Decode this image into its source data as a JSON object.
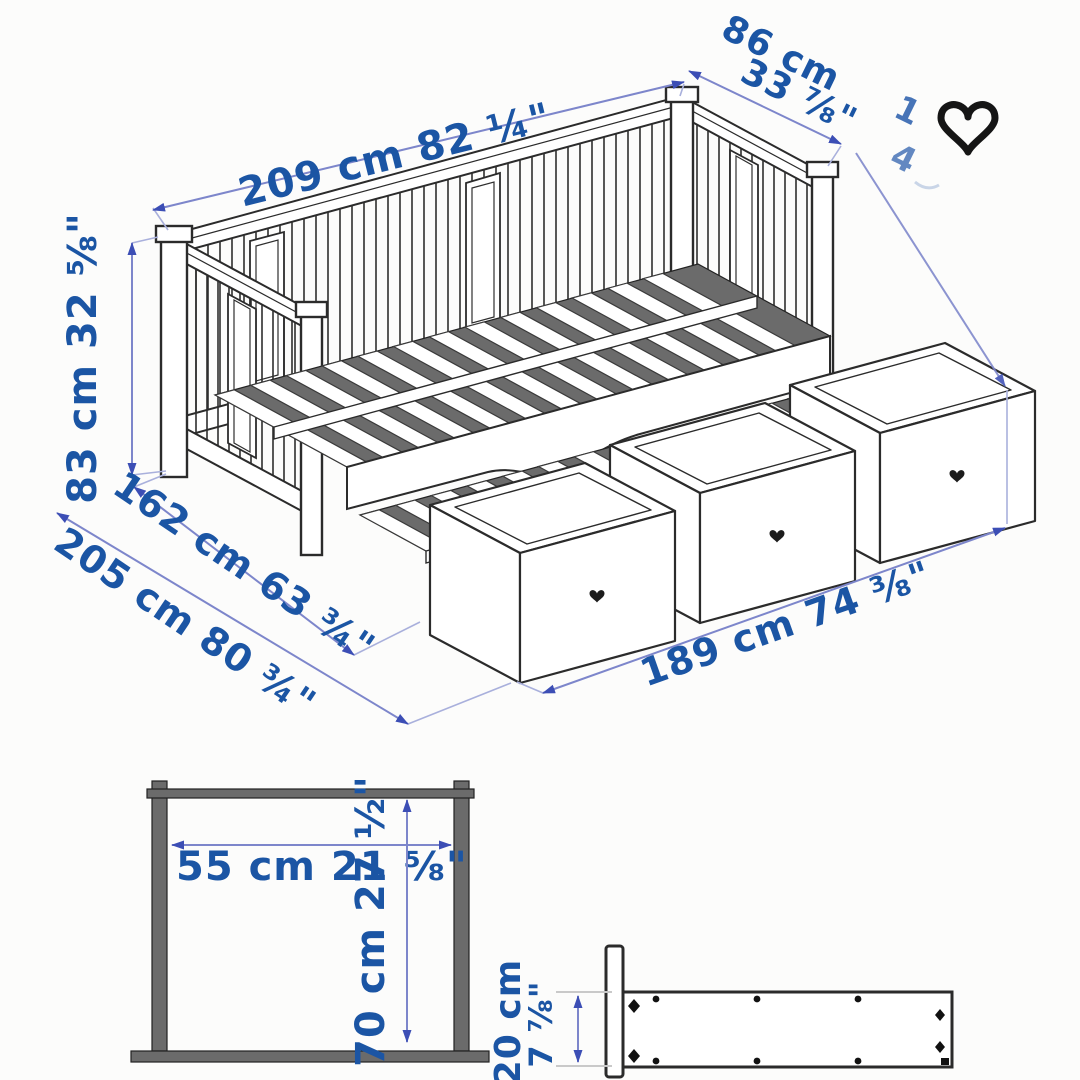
{
  "page": {
    "background": "#fcfcfb",
    "description": "Isometric dimension drawing of a daybed with three storage drawers, plus headboard clearance and side-rail detail views"
  },
  "colors": {
    "dim_text": "#1b55a4",
    "dim_line": "#7d86cb",
    "dim_arrow": "#3c4eb5",
    "draw_stroke": "#2b2b2b",
    "gray_fill": "#6b6b6b",
    "heart_icon": "#151515"
  },
  "main_diagram": {
    "dims": {
      "length_top": "209 cm 82 ¼\"",
      "depth_top_1": "86 cm",
      "depth_top_2": "33 ⅞\"",
      "faded_1": "1",
      "faded_2": "4",
      "height": "83 cm 32 ⅝\"",
      "mattress_width": "162 cm 63 ¾\"",
      "total_depth": "205 cm 80 ¾\"",
      "front_length": "189 cm 74 ⅜\""
    },
    "heart_icon": "favorite-heart"
  },
  "headboard_diagram": {
    "width": "55 cm 21 ⅝\"",
    "height": "70 cm 27 ½\""
  },
  "rail_diagram": {
    "height_1": "20 cm",
    "height_2": "7 ⅞\""
  }
}
